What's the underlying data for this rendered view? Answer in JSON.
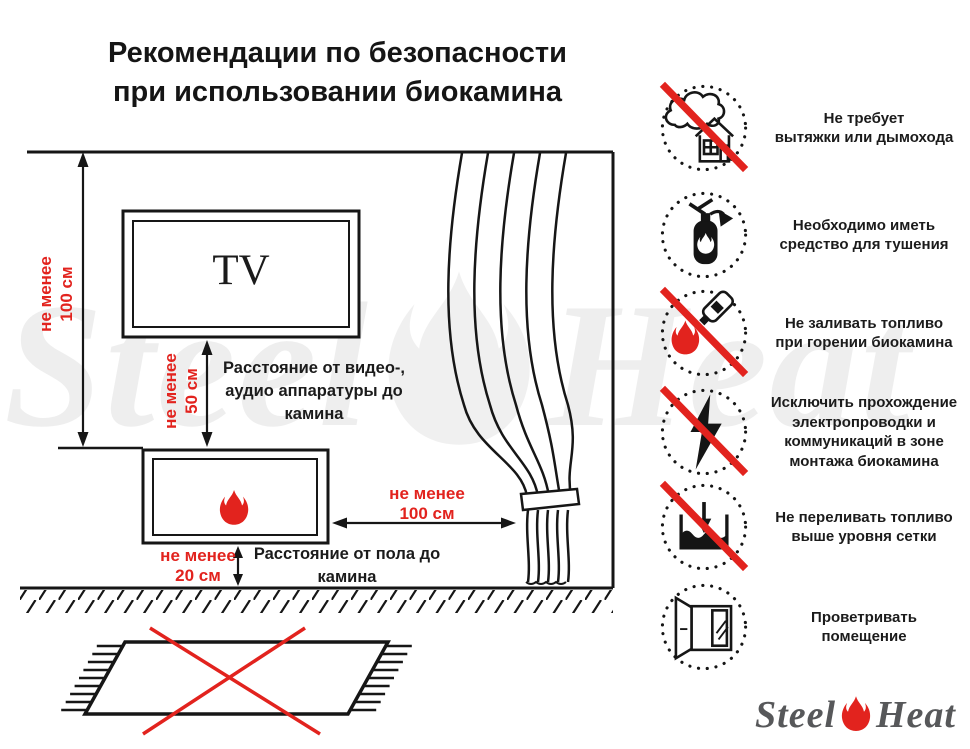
{
  "title": "Рекомендации по безопасности\nпри использовании биокамина",
  "colors": {
    "accent_red": "#e2231e",
    "line_black": "#1b1b1b",
    "logo_gray": "#57585a"
  },
  "diagram": {
    "tv_label": "TV",
    "dim_wall_to_fireplace": "не менее\n100 см",
    "dim_tv_to_fireplace": "не менее\n50 см",
    "dim_curtain_to_fireplace": "не менее\n100 см",
    "dim_floor_to_fireplace": "не менее\n20 см",
    "note_av_equipment": "Расстояние от видео-,\nаудио аппаратуры до\nкамина",
    "note_floor": "Расстояние от пола до\nкамина"
  },
  "safety_items": [
    {
      "icon": "no-chimney-needed",
      "crossed": true,
      "text": "Не требует\nвытяжки или дымохода"
    },
    {
      "icon": "extinguisher-required",
      "crossed": false,
      "text": "Необходимо иметь\nсредство для тушения"
    },
    {
      "icon": "no-refueling-while-burning",
      "crossed": true,
      "text": "Не заливать топливо\nпри горении биокамина"
    },
    {
      "icon": "no-electrical-wiring",
      "crossed": true,
      "text": "Исключить прохождение\nэлектропроводки и\nкоммуникаций в зоне\nмонтажа биокамина"
    },
    {
      "icon": "no-overfilling",
      "crossed": true,
      "text": "Не переливать топливо\nвыше уровня сетки"
    },
    {
      "icon": "ventilate-room",
      "crossed": false,
      "text": "Проветривать\nпомещение"
    }
  ],
  "logo": {
    "part1": "Steel",
    "part2": "Heat"
  }
}
